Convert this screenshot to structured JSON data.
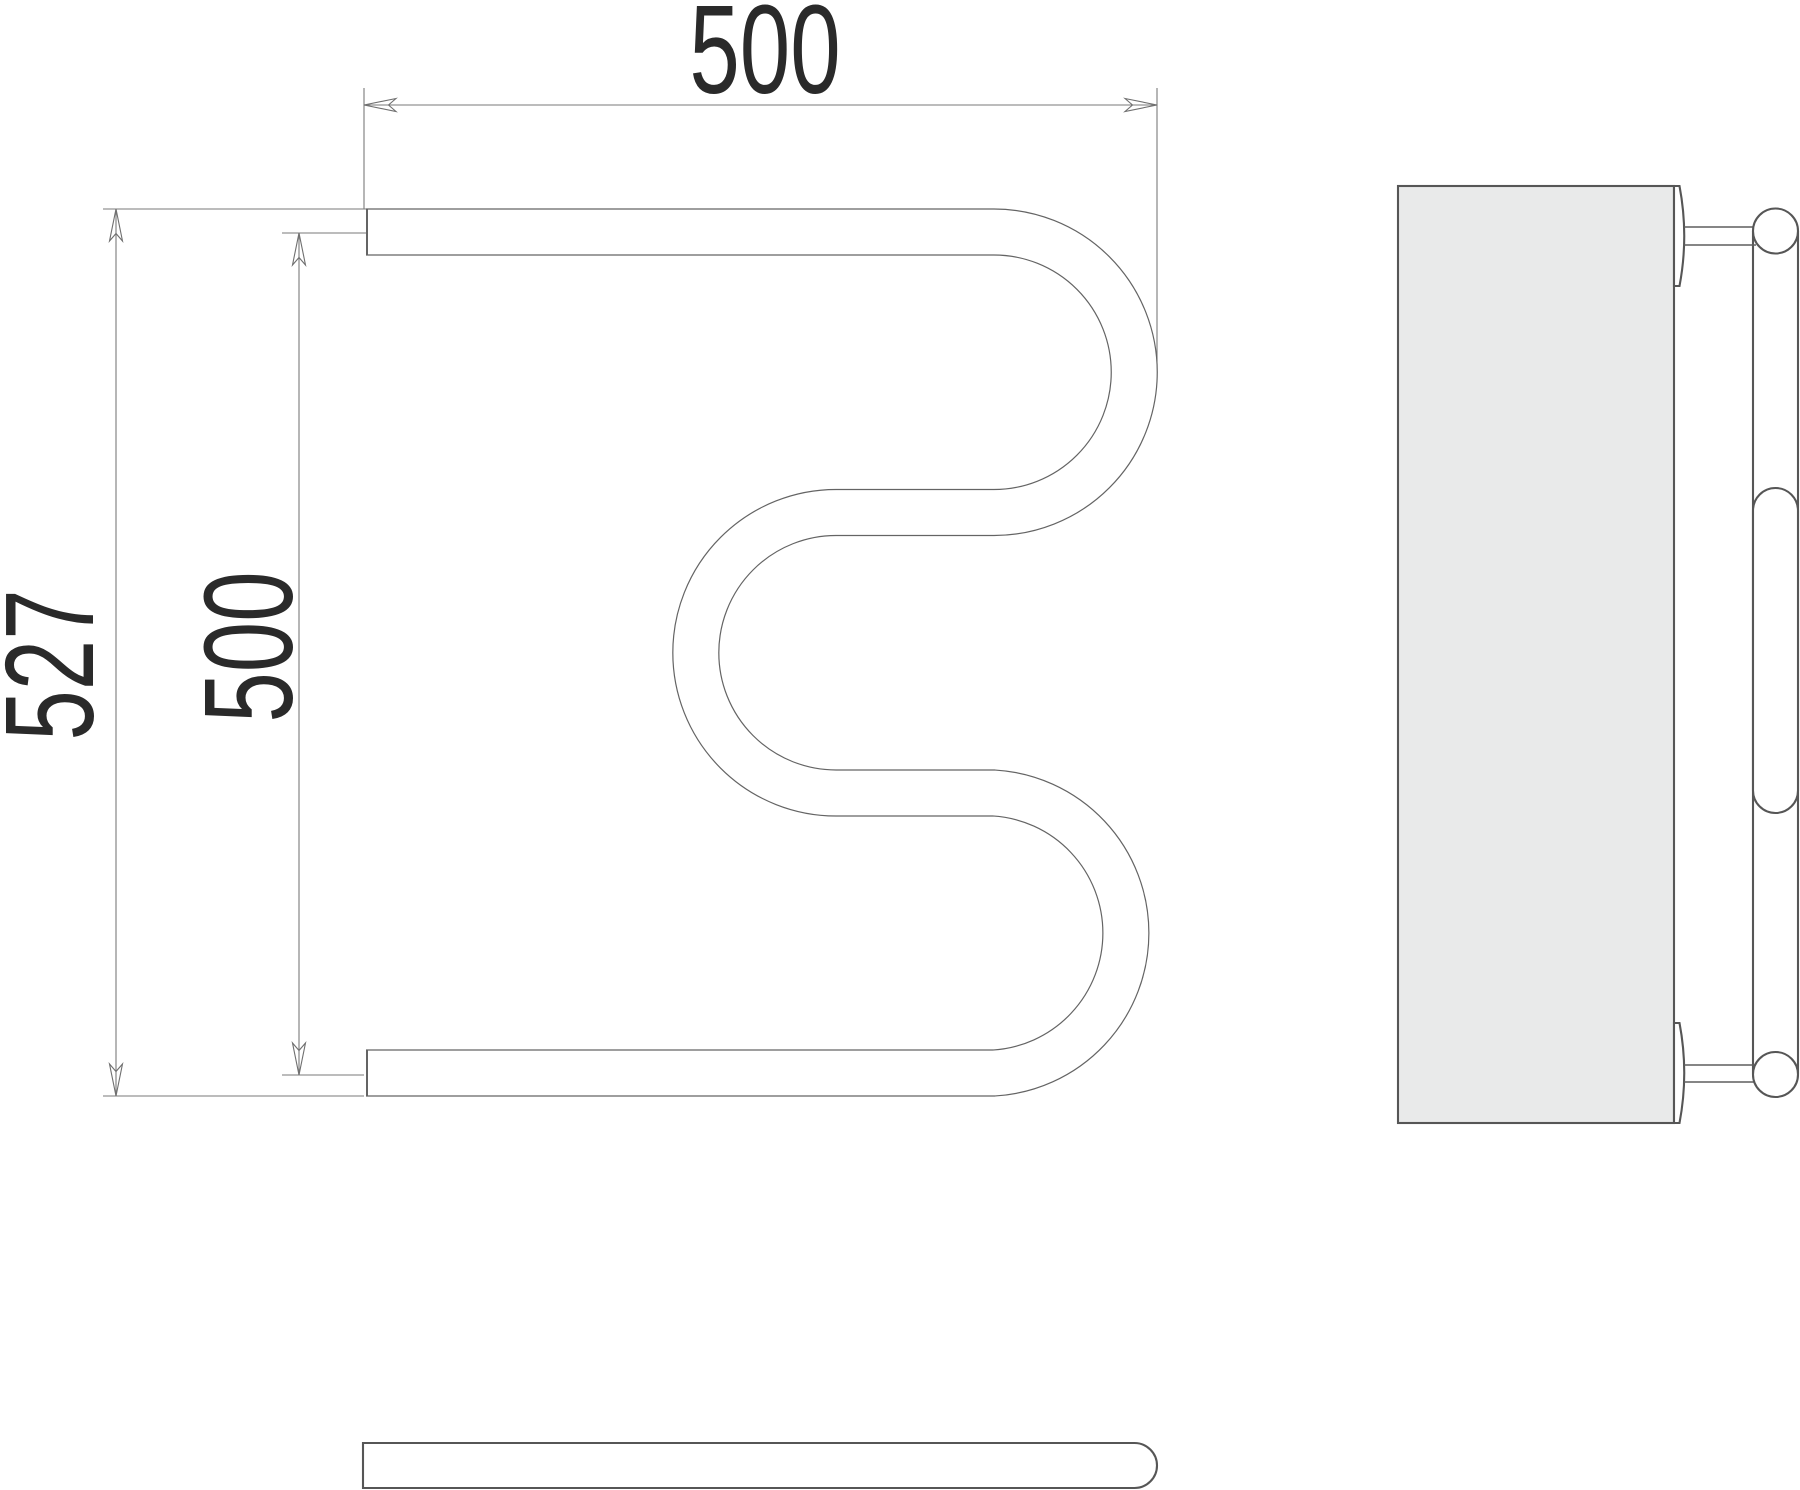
{
  "page": {
    "description": "Technical drawing of M-shaped towel radiator with three orthographic views",
    "background": "#ffffff"
  },
  "dimensions": {
    "overall_width": {
      "value": "500"
    },
    "overall_height": {
      "value": "527"
    },
    "axis_height": {
      "value": "500"
    }
  },
  "views": {
    "front": {
      "name": "front view (M-shaped tube)"
    },
    "side": {
      "name": "side view (wall panel with mounts)"
    },
    "bottom": {
      "name": "bottom view (tube capsule)"
    }
  },
  "colors": {
    "tube_outline": "#646464",
    "dimension_lines": "#7a7a7a",
    "text": "#2a2a2a",
    "wall_fill": "#e9eaea",
    "heavy_outline": "#565656",
    "background": "#ffffff"
  }
}
